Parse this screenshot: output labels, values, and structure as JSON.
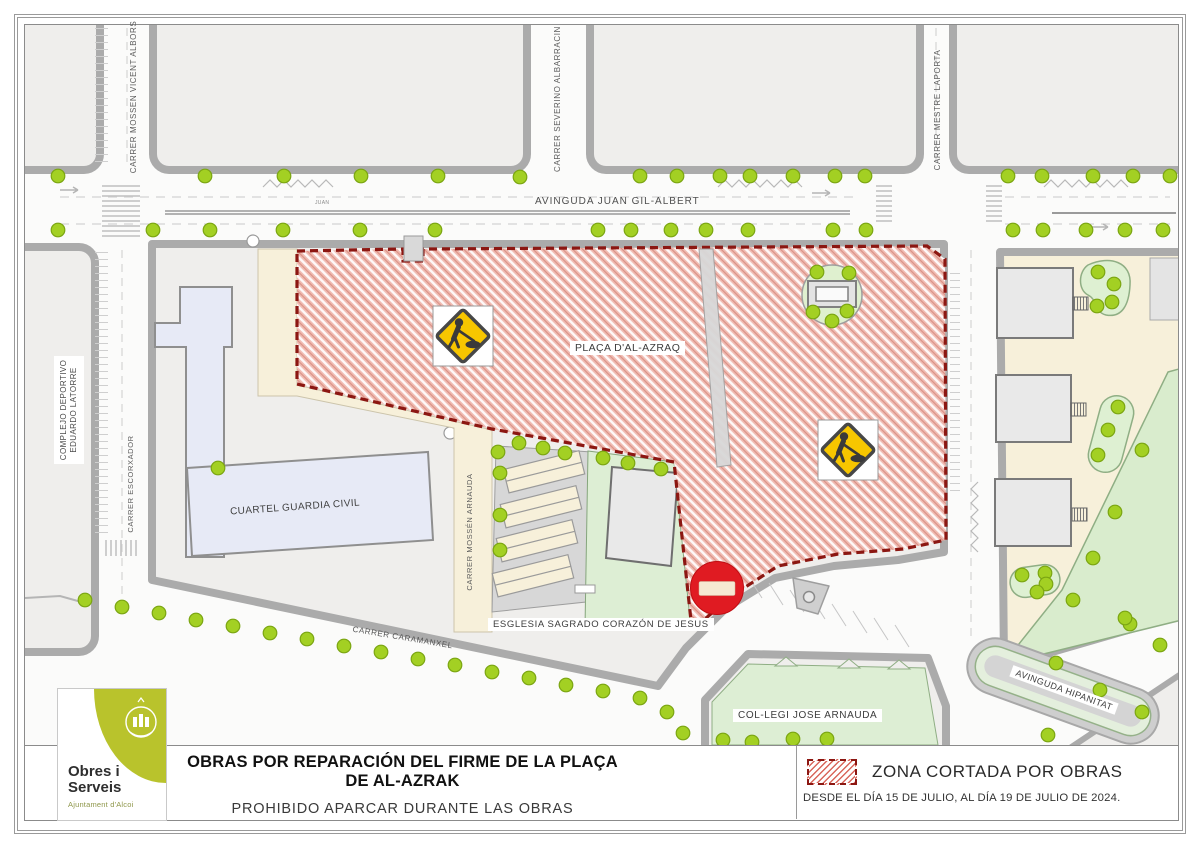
{
  "title_block": {
    "line1": "OBRAS POR REPARACIÓN DEL FIRME DE LA PLAÇA DE AL-AZRAK",
    "line2": "PROHIBIDO APARCAR DURANTE LAS OBRAS"
  },
  "legend": {
    "label": "ZONA CORTADA POR OBRAS",
    "dates": "DESDE EL DÍA 15 DE JULIO, AL DÍA 19 DE JULIO DE 2024."
  },
  "logo": {
    "name1": "Obres i",
    "name2": "Serveis",
    "sub": "Ajuntament d'Alcoi"
  },
  "map": {
    "street_labels": {
      "avinguda_juan": "AVINGUDA JUAN GIL-ALBERT",
      "juan_small": "JUAN",
      "mossen_vicent_albors": "CARRER MOSSEN VICENT ALBORS",
      "severino_albarracin": "CARRER SEVERINO ALBARRACIN",
      "mestre_laporta": "CARRER MESTRE LAPORTA",
      "escorxador": "CARRER ESCORXADOR",
      "mossen_arnauda": "CARRER MOSSÉN ARNAUDA",
      "caramanxel": "CARRER CARAMANXEL",
      "avinguda_hipanitat": "AVINGUDA HIPANITAT"
    },
    "place_labels": {
      "complejo_line1": "COMPLEJO DEPORTIVO",
      "complejo_line2": "EDUARDO LATORRE",
      "placa": "PLAÇA D'AL-AZRAQ",
      "cuartel": "CUARTEL GUARDIA CIVIL",
      "esglesia": "ESGLESIA SAGRADO CORAZÓN DE JESUS",
      "collegi": "COL-LEGI JOSE ARNAUDA"
    },
    "signs": {
      "roadworks": "roadworks-warning-sign",
      "no_entry": "no-entry-sign"
    },
    "colors": {
      "zone_fill": "#f0bcb3",
      "zone_hatch_line": "#ffffff",
      "zone_border": "#8c1712",
      "tree": "#a3d023",
      "tree_edge": "#7ba512",
      "sign_yellow": "#f7c600",
      "no_entry_red": "#e01b22",
      "logo_green": "#b9c32c",
      "cream": "#f7f0da",
      "green_area": "#ddeed4",
      "building_lavender": "#e7eaf6"
    },
    "trees": [
      [
        58,
        176
      ],
      [
        205,
        176
      ],
      [
        284,
        176
      ],
      [
        361,
        176
      ],
      [
        438,
        176
      ],
      [
        520,
        177
      ],
      [
        640,
        176
      ],
      [
        677,
        176
      ],
      [
        720,
        176
      ],
      [
        750,
        176
      ],
      [
        793,
        176
      ],
      [
        835,
        176
      ],
      [
        865,
        176
      ],
      [
        1008,
        176
      ],
      [
        1042,
        176
      ],
      [
        1093,
        176
      ],
      [
        1133,
        176
      ],
      [
        1170,
        176
      ],
      [
        58,
        230
      ],
      [
        153,
        230
      ],
      [
        210,
        230
      ],
      [
        283,
        230
      ],
      [
        360,
        230
      ],
      [
        435,
        230
      ],
      [
        598,
        230
      ],
      [
        631,
        230
      ],
      [
        671,
        230
      ],
      [
        706,
        230
      ],
      [
        748,
        230
      ],
      [
        833,
        230
      ],
      [
        866,
        230
      ],
      [
        1013,
        230
      ],
      [
        1043,
        230
      ],
      [
        1086,
        230
      ],
      [
        1125,
        230
      ],
      [
        1163,
        230
      ],
      [
        817,
        272
      ],
      [
        849,
        273
      ],
      [
        813,
        312
      ],
      [
        847,
        311
      ],
      [
        832,
        321
      ],
      [
        218,
        468
      ],
      [
        498,
        452
      ],
      [
        500,
        473
      ],
      [
        500,
        515
      ],
      [
        500,
        550
      ],
      [
        519,
        443
      ],
      [
        543,
        448
      ],
      [
        565,
        453
      ],
      [
        603,
        458
      ],
      [
        628,
        463
      ],
      [
        661,
        469
      ],
      [
        85,
        600
      ],
      [
        122,
        607
      ],
      [
        159,
        613
      ],
      [
        196,
        620
      ],
      [
        233,
        626
      ],
      [
        270,
        633
      ],
      [
        307,
        639
      ],
      [
        344,
        646
      ],
      [
        381,
        652
      ],
      [
        418,
        659
      ],
      [
        455,
        665
      ],
      [
        492,
        672
      ],
      [
        529,
        678
      ],
      [
        566,
        685
      ],
      [
        603,
        691
      ],
      [
        640,
        698
      ],
      [
        667,
        712
      ],
      [
        683,
        733
      ],
      [
        723,
        740
      ],
      [
        752,
        742
      ],
      [
        793,
        739
      ],
      [
        827,
        739
      ],
      [
        1130,
        624
      ],
      [
        1056,
        663
      ],
      [
        1100,
        690
      ],
      [
        1142,
        712
      ],
      [
        1048,
        735
      ],
      [
        1098,
        272
      ],
      [
        1114,
        284
      ],
      [
        1112,
        302
      ],
      [
        1097,
        306
      ],
      [
        1118,
        407
      ],
      [
        1108,
        430
      ],
      [
        1098,
        455
      ],
      [
        1022,
        575
      ],
      [
        1045,
        573
      ],
      [
        1046,
        584
      ],
      [
        1037,
        592
      ],
      [
        1142,
        450
      ],
      [
        1115,
        512
      ],
      [
        1093,
        558
      ],
      [
        1073,
        600
      ],
      [
        1125,
        618
      ],
      [
        1160,
        645
      ]
    ]
  }
}
